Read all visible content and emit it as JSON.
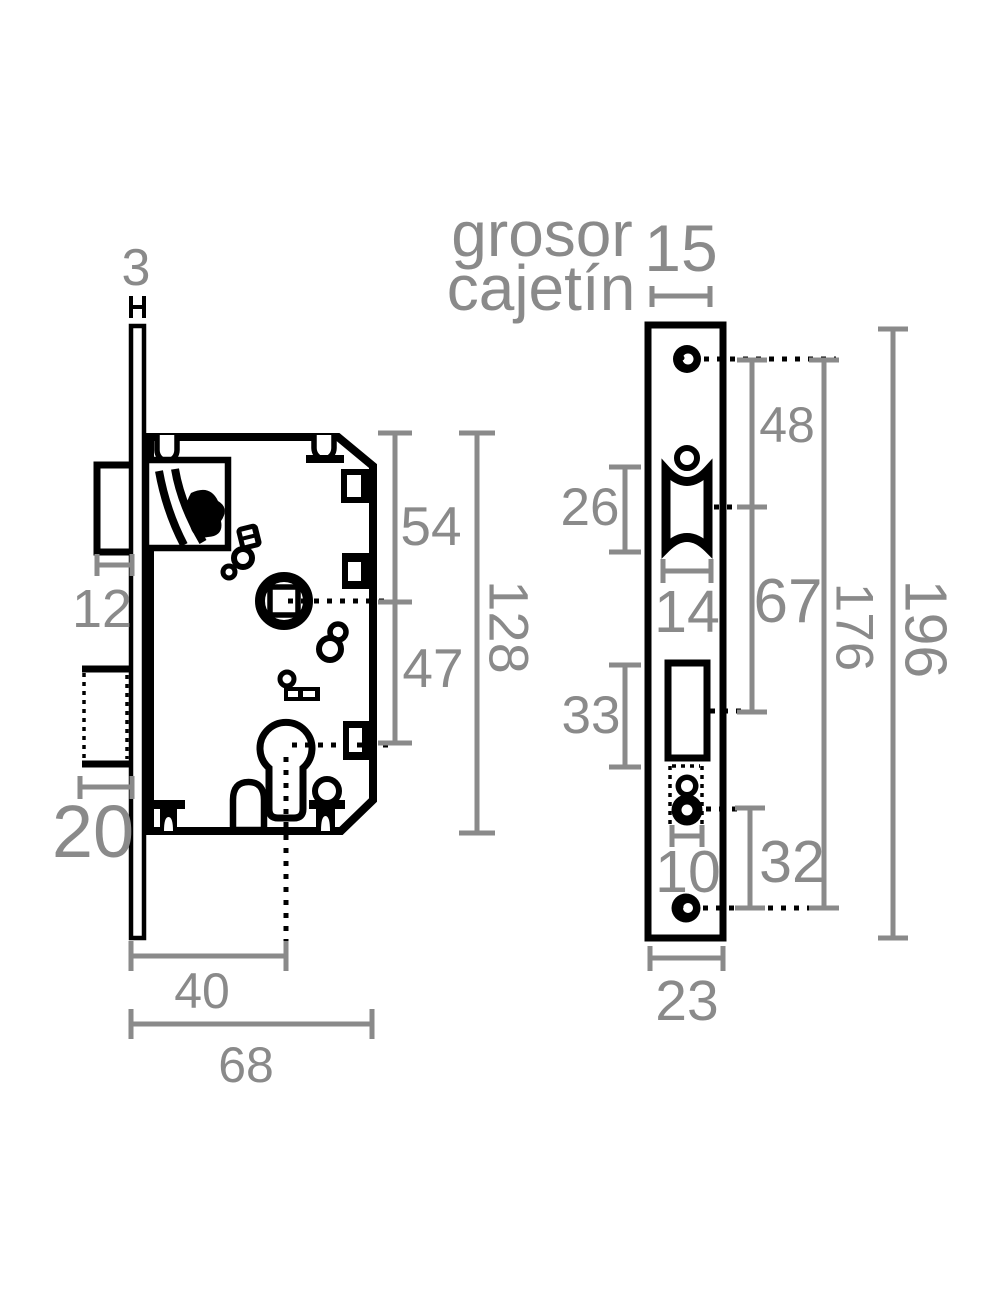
{
  "colors": {
    "background": "#ffffff",
    "drawing_line": "#000000",
    "dimension": "#8a8a8a"
  },
  "side_view": {
    "dims": {
      "faceplate_thickness": "3",
      "latch_projection": "12",
      "deadbolt_projection": "20",
      "top_to_follower": "54",
      "follower_to_cylinder": "47",
      "case_height": "128",
      "backset": "40",
      "case_depth": "68"
    }
  },
  "front_view": {
    "caption_line1": "grosor",
    "caption_line2": "cajetín",
    "dims": {
      "case_thickness": "15",
      "latch_cutout_height": "26",
      "latch_cutout_width": "14",
      "top_screw_to_latch": "48",
      "latch_to_deadbolt": "67",
      "deadbolt_cutout_height": "33",
      "cylinder_hole_width": "10",
      "cylinder_to_bottom_screw": "32",
      "screw_spacing": "176",
      "faceplate_height": "196",
      "faceplate_width": "23"
    }
  }
}
